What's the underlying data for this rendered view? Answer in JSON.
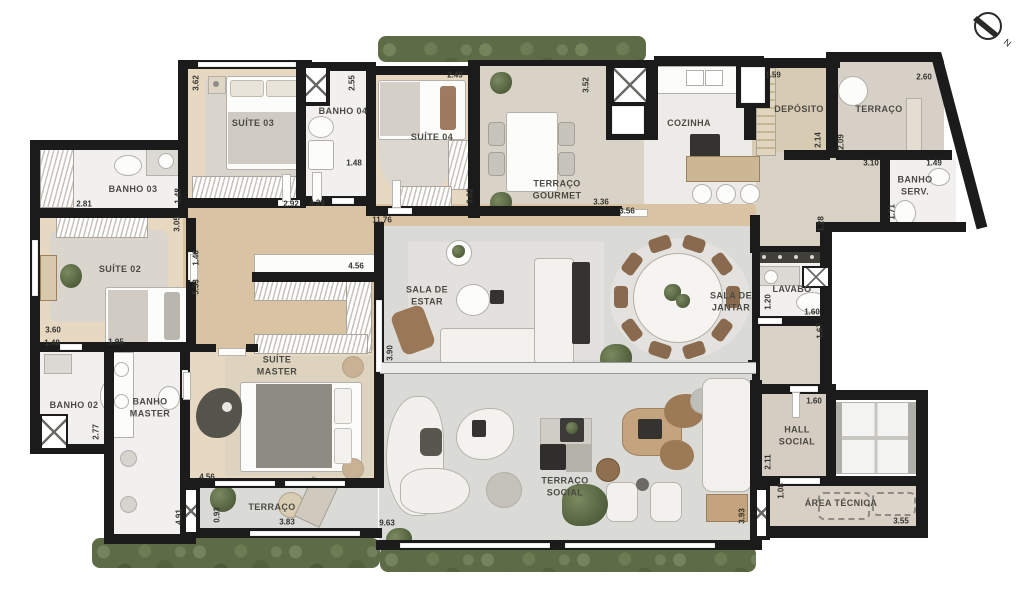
{
  "compass": {
    "label": "N"
  },
  "rooms": [
    {
      "id": "suite-03",
      "label": "SUÍTE 03",
      "x": 253,
      "y": 124
    },
    {
      "id": "banho-04",
      "label": "BANHO 04",
      "x": 343,
      "y": 112
    },
    {
      "id": "suite-04",
      "label": "SUÍTE 04",
      "x": 432,
      "y": 138
    },
    {
      "id": "terraco-gourmet",
      "label": "TERRAÇO\nGOURMET",
      "x": 557,
      "y": 190
    },
    {
      "id": "cozinha",
      "label": "COZINHA",
      "x": 689,
      "y": 124
    },
    {
      "id": "deposito",
      "label": "DEPÓSITO",
      "x": 799,
      "y": 110
    },
    {
      "id": "terraco-superior",
      "label": "TERRAÇO",
      "x": 879,
      "y": 110
    },
    {
      "id": "banho-serv",
      "label": "BANHO\nSERV.",
      "x": 915,
      "y": 186
    },
    {
      "id": "banho-03",
      "label": "BANHO 03",
      "x": 133,
      "y": 190
    },
    {
      "id": "suite-02",
      "label": "SUÍTE 02",
      "x": 120,
      "y": 270
    },
    {
      "id": "banho-02",
      "label": "BANHO 02",
      "x": 74,
      "y": 406
    },
    {
      "id": "banho-master",
      "label": "BANHO\nMASTER",
      "x": 150,
      "y": 408
    },
    {
      "id": "suite-master",
      "label": "SUÍTE\nMASTER",
      "x": 277,
      "y": 366
    },
    {
      "id": "sala-de-estar",
      "label": "SALA DE\nESTAR",
      "x": 427,
      "y": 296
    },
    {
      "id": "sala-de-jantar",
      "label": "SALA DE\nJANTAR",
      "x": 731,
      "y": 302
    },
    {
      "id": "lavabo",
      "label": "LAVABO",
      "x": 792,
      "y": 290
    },
    {
      "id": "terraco-inferior",
      "label": "TERRAÇO",
      "x": 272,
      "y": 508
    },
    {
      "id": "terraco-social",
      "label": "TERRAÇO\nSOCIAL",
      "x": 565,
      "y": 487
    },
    {
      "id": "hall-social",
      "label": "HALL\nSOCIAL",
      "x": 797,
      "y": 436
    },
    {
      "id": "area-tecnica",
      "label": "ÁREA TÉCNICA",
      "x": 841,
      "y": 504
    }
  ],
  "dimensions": [
    {
      "text": "3.62",
      "x": 196,
      "y": 83,
      "v": 1
    },
    {
      "text": "2.55",
      "x": 352,
      "y": 83,
      "v": 1
    },
    {
      "text": "2.49",
      "x": 455,
      "y": 75,
      "v": 0
    },
    {
      "text": "3.52",
      "x": 586,
      "y": 85,
      "v": 1
    },
    {
      "text": "1.59",
      "x": 773,
      "y": 75,
      "v": 0
    },
    {
      "text": "2.60",
      "x": 924,
      "y": 77,
      "v": 0
    },
    {
      "text": "2.14",
      "x": 818,
      "y": 140,
      "v": 1
    },
    {
      "text": "2.09",
      "x": 841,
      "y": 142,
      "v": 1
    },
    {
      "text": "3.10",
      "x": 871,
      "y": 163,
      "v": 0
    },
    {
      "text": "1.49",
      "x": 934,
      "y": 163,
      "v": 0
    },
    {
      "text": "1.71",
      "x": 892,
      "y": 212,
      "v": 1
    },
    {
      "text": "1.28",
      "x": 821,
      "y": 224,
      "v": 1
    },
    {
      "text": "1.48",
      "x": 354,
      "y": 163,
      "v": 0
    },
    {
      "text": "2.92",
      "x": 291,
      "y": 204,
      "v": 0
    },
    {
      "text": "4.29",
      "x": 317,
      "y": 203,
      "v": 0
    },
    {
      "text": "11.76",
      "x": 382,
      "y": 220,
      "v": 0
    },
    {
      "text": "3.62",
      "x": 470,
      "y": 196,
      "v": 1
    },
    {
      "text": "3.36",
      "x": 601,
      "y": 202,
      "v": 0
    },
    {
      "text": "3.56",
      "x": 627,
      "y": 211,
      "v": 0
    },
    {
      "text": "2.81",
      "x": 84,
      "y": 204,
      "v": 0
    },
    {
      "text": "1.48",
      "x": 178,
      "y": 196,
      "v": 1
    },
    {
      "text": "3.05",
      "x": 177,
      "y": 224,
      "v": 1
    },
    {
      "text": "1.46",
      "x": 196,
      "y": 258,
      "v": 1
    },
    {
      "text": "5.33",
      "x": 196,
      "y": 287,
      "v": 1
    },
    {
      "text": "3.60",
      "x": 53,
      "y": 330,
      "v": 0
    },
    {
      "text": "1.48",
      "x": 52,
      "y": 343,
      "v": 0
    },
    {
      "text": "1.95",
      "x": 116,
      "y": 342,
      "v": 0
    },
    {
      "text": "2.77",
      "x": 96,
      "y": 432,
      "v": 1
    },
    {
      "text": "4.56",
      "x": 356,
      "y": 266,
      "v": 0
    },
    {
      "text": "4.56",
      "x": 207,
      "y": 477,
      "v": 0
    },
    {
      "text": "4.91",
      "x": 179,
      "y": 517,
      "v": 1
    },
    {
      "text": "0.93",
      "x": 217,
      "y": 515,
      "v": 1
    },
    {
      "text": "3.83",
      "x": 287,
      "y": 522,
      "v": 0
    },
    {
      "text": "3.90",
      "x": 390,
      "y": 353,
      "v": 1
    },
    {
      "text": "9.63",
      "x": 387,
      "y": 523,
      "v": 0
    },
    {
      "text": "3.93",
      "x": 742,
      "y": 516,
      "v": 1
    },
    {
      "text": "1.20",
      "x": 768,
      "y": 302,
      "v": 1
    },
    {
      "text": "1.60",
      "x": 812,
      "y": 312,
      "v": 0
    },
    {
      "text": "1.67",
      "x": 820,
      "y": 331,
      "v": 1
    },
    {
      "text": "1.60",
      "x": 814,
      "y": 401,
      "v": 0
    },
    {
      "text": "2.11",
      "x": 768,
      "y": 462,
      "v": 1
    },
    {
      "text": "1.08",
      "x": 781,
      "y": 491,
      "v": 1
    },
    {
      "text": "3.55",
      "x": 901,
      "y": 521,
      "v": 0
    }
  ]
}
